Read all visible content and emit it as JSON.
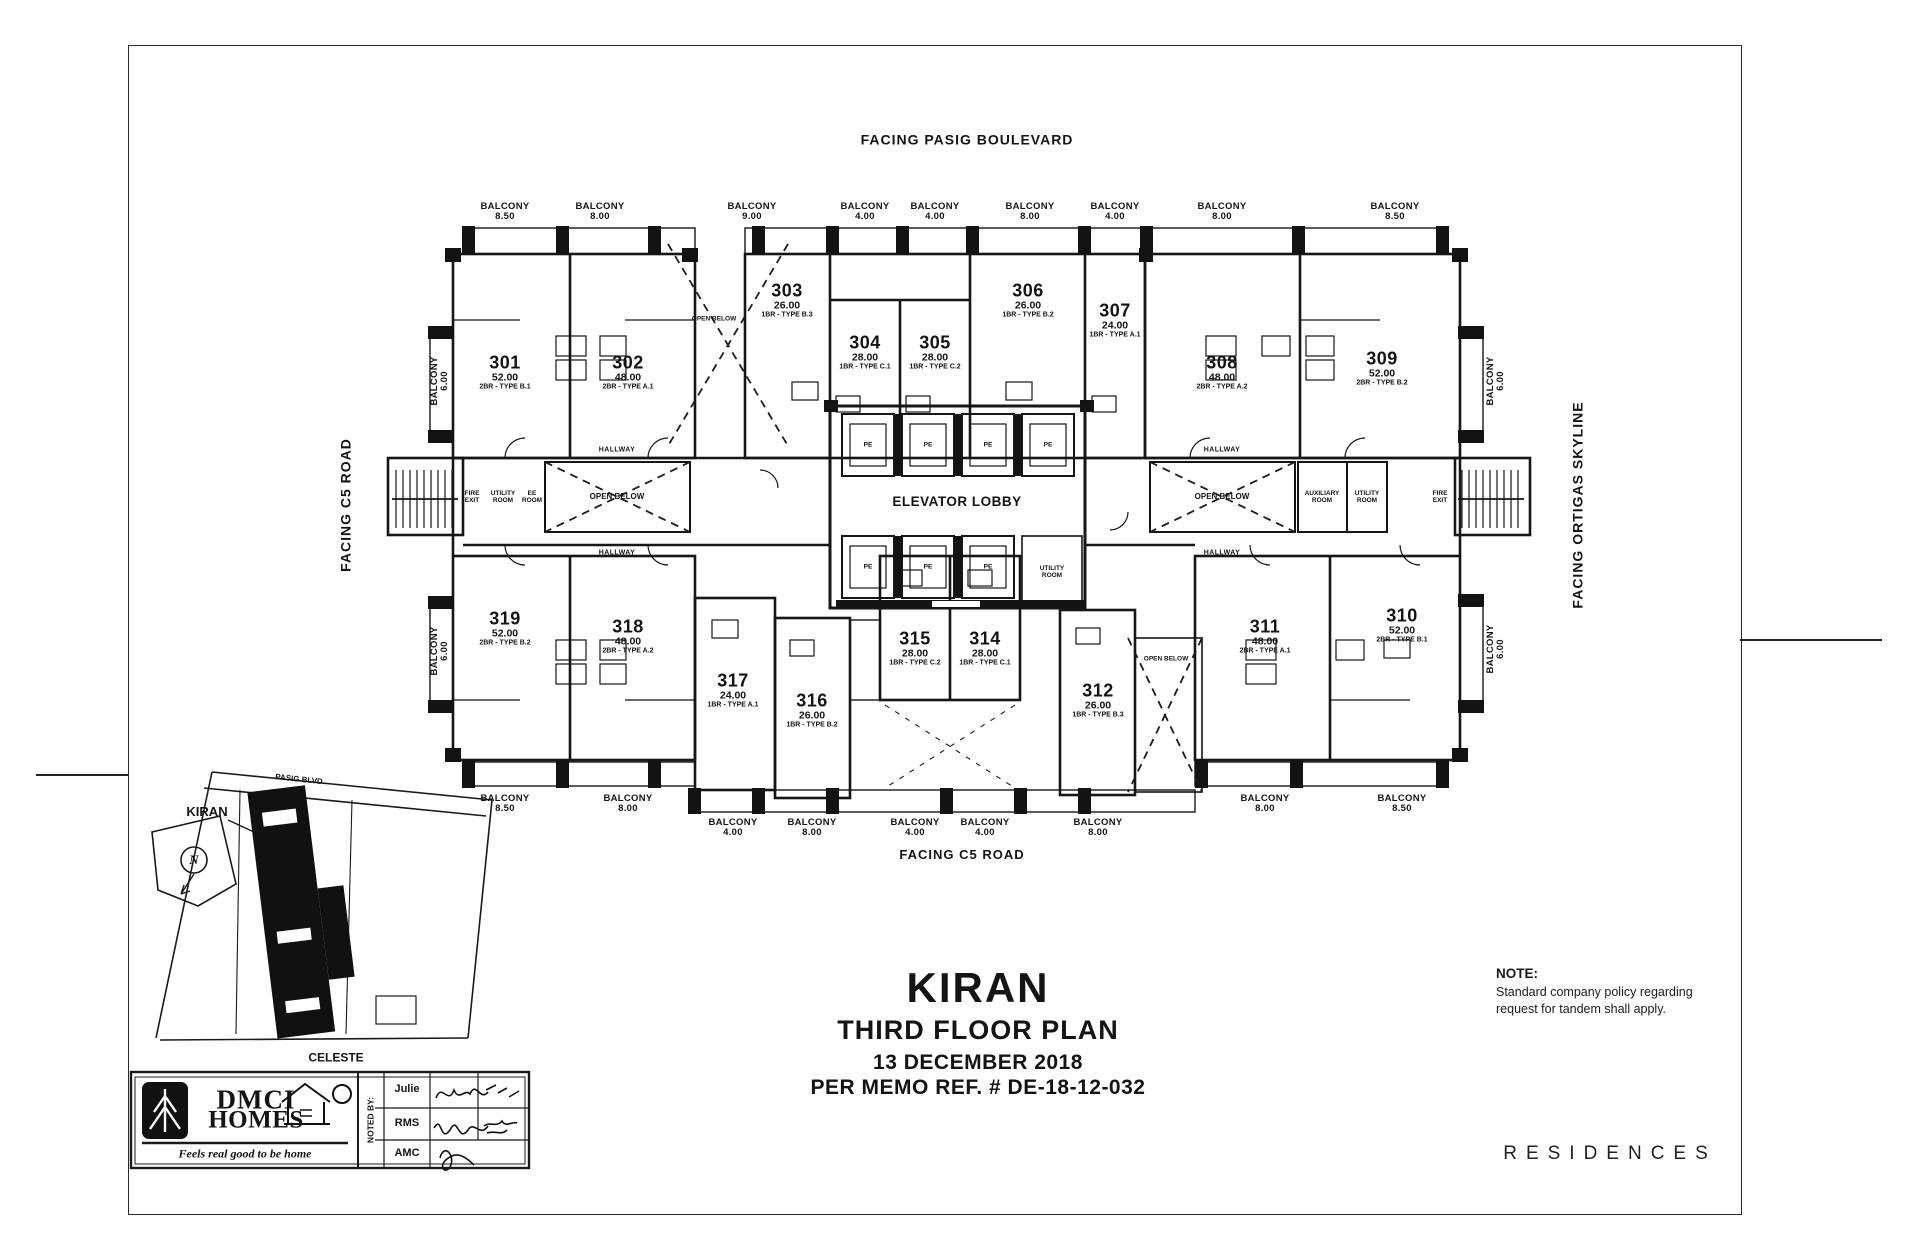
{
  "sheet": {
    "facing_top": "FACING PASIG BOULEVARD",
    "facing_left": "FACING C5 ROAD",
    "facing_right": "FACING ORTIGAS SKYLINE",
    "facing_bottom": "FACING C5 ROAD"
  },
  "title_block": {
    "project": "KIRAN",
    "title": "THIRD FLOOR PLAN",
    "date": "13 DECEMBER 2018",
    "memo": "PER MEMO REF. #  DE-18-12-032"
  },
  "note": {
    "heading": "NOTE:",
    "line1": "Standard company policy regarding",
    "line2": "request for tandem shall apply."
  },
  "brand": {
    "logo_line1": "DMCI",
    "logo_line2": "HOMES",
    "tagline": "Feels real good to be home",
    "noted_by": "NOTED BY:",
    "sig1": "Julie",
    "sig2": "RMS",
    "sig3": "AMC",
    "residences": "RESIDENCES"
  },
  "inset": {
    "project": "KIRAN",
    "neighbor": "CELESTE",
    "street": "PASIG BLVD.",
    "north": "N"
  },
  "rooms": {
    "elevator_lobby": "ELEVATOR LOBBY",
    "utility_room": "UTILITY ROOM",
    "auxiliary_room": "AUXILIARY ROOM",
    "fire_exit": "FIRE EXIT",
    "ee_room": "EE ROOM",
    "open_below": "OPEN BELOW",
    "hallway": "HALLWAY",
    "pe": "PE"
  },
  "balcony_label": "BALCONY",
  "balconies_top": [
    "8.50",
    "8.00",
    "9.00",
    "4.00",
    "4.00",
    "8.00",
    "4.00",
    "8.00",
    "8.50"
  ],
  "balconies_bottom": [
    "8.50",
    "8.00",
    "4.00",
    "8.00",
    "4.00",
    "4.00",
    "8.00",
    "8.00",
    "8.50"
  ],
  "balconies_side": [
    "6.00",
    "6.00",
    "6.00",
    "6.00"
  ],
  "units": {
    "301": {
      "no": "301",
      "area": "52.00",
      "type": "2BR - TYPE B.1"
    },
    "302": {
      "no": "302",
      "area": "48.00",
      "type": "2BR - TYPE A.1"
    },
    "303": {
      "no": "303",
      "area": "26.00",
      "type": "1BR - TYPE B.3"
    },
    "304": {
      "no": "304",
      "area": "28.00",
      "type": "1BR - TYPE C.1"
    },
    "305": {
      "no": "305",
      "area": "28.00",
      "type": "1BR - TYPE C.2"
    },
    "306": {
      "no": "306",
      "area": "26.00",
      "type": "1BR - TYPE B.2"
    },
    "307": {
      "no": "307",
      "area": "24.00",
      "type": "1BR - TYPE A.1"
    },
    "308": {
      "no": "308",
      "area": "48.00",
      "type": "2BR - TYPE A.2"
    },
    "309": {
      "no": "309",
      "area": "52.00",
      "type": "2BR - TYPE B.2"
    },
    "310": {
      "no": "310",
      "area": "52.00",
      "type": "2BR - TYPE B.1"
    },
    "311": {
      "no": "311",
      "area": "48.00",
      "type": "2BR - TYPE A.1"
    },
    "312": {
      "no": "312",
      "area": "26.00",
      "type": "1BR - TYPE B.3"
    },
    "314": {
      "no": "314",
      "area": "28.00",
      "type": "1BR - TYPE C.1"
    },
    "315": {
      "no": "315",
      "area": "28.00",
      "type": "1BR - TYPE C.2"
    },
    "316": {
      "no": "316",
      "area": "26.00",
      "type": "1BR - TYPE B.2"
    },
    "317": {
      "no": "317",
      "area": "24.00",
      "type": "1BR - TYPE A.1"
    },
    "318": {
      "no": "318",
      "area": "48.00",
      "type": "2BR - TYPE A.2"
    },
    "319": {
      "no": "319",
      "area": "52.00",
      "type": "2BR - TYPE B.2"
    }
  }
}
